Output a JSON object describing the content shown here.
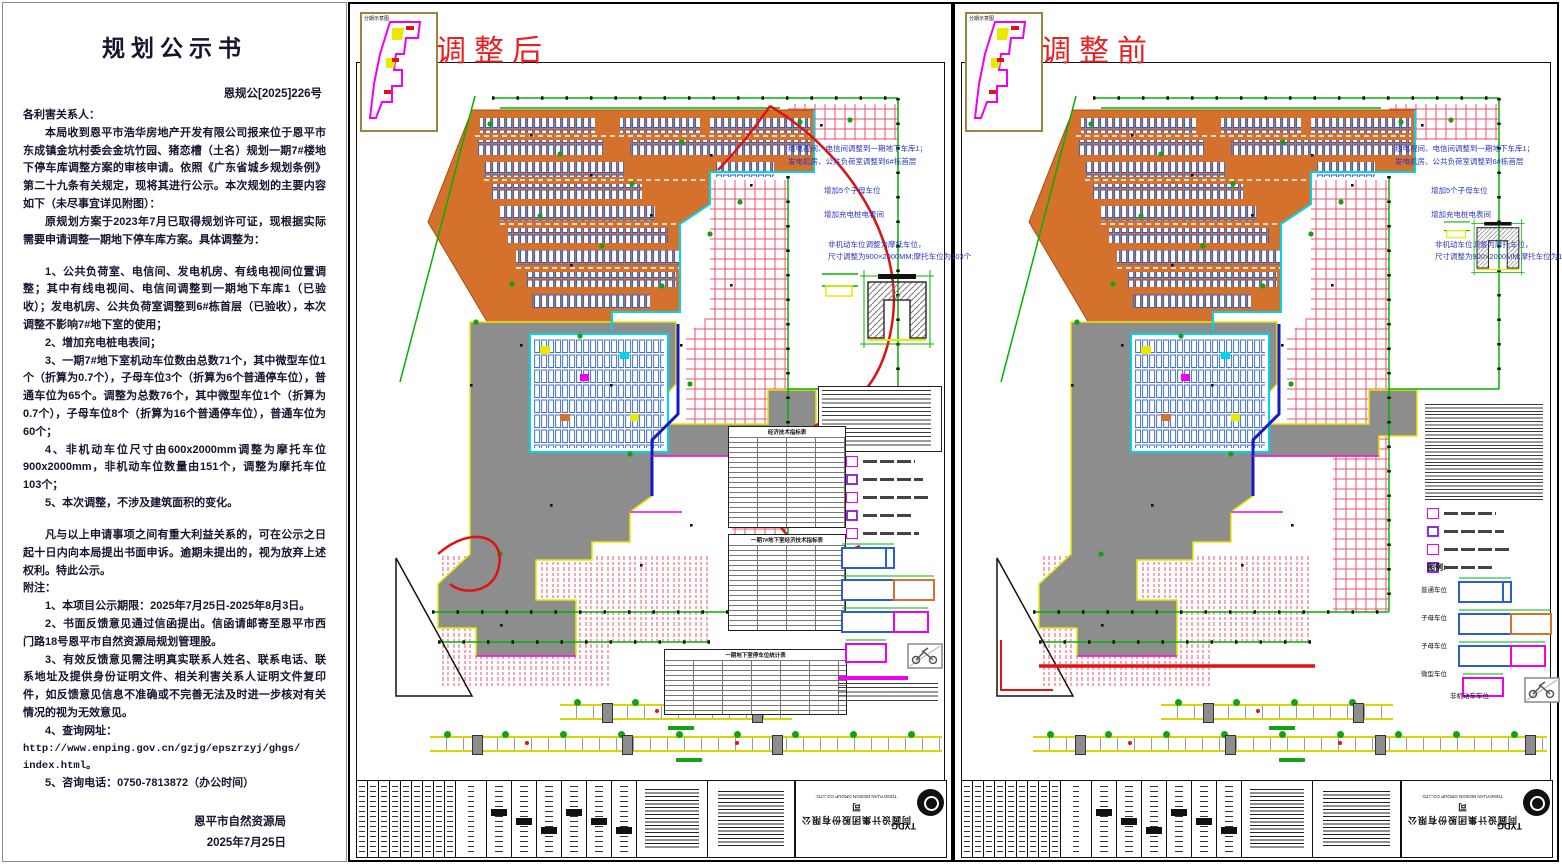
{
  "colors": {
    "accent_red": "#e01212",
    "boundary_green": "#00b400",
    "hatch_red": "#ef5168",
    "building_orange": "#d4712d",
    "stall_blue": "#2b5fd0",
    "magenta": "#f000f0",
    "cyan": "#00d4e8",
    "basement_gray": "#8d8d8d",
    "outline_yellow": "#e8e800",
    "annotation_blue": "#2a35c0",
    "doc_text": "#151530"
  },
  "document": {
    "title": "规划公示书",
    "doc_number": "恩规公[2025]226号",
    "salutation": "各利害关系人：",
    "p1": "本局收到恩平市浩华房地产开发有限公司报来位于恩平市东成镇金坑村委会金坑竹园、猪恋槽（土名）规划一期7#楼地下停车库调整方案的审核申请。依照《广东省城乡规划条例》第二十九条有关规定，现将其进行公示。本次规划的主要内容如下（未尽事宜详见附图）：",
    "p2": "原规划方案于2023年7月已取得规划许可证，现根据实际需要申请调整一期地下停车库方案。具体调整为：",
    "items": [
      "1、公共负荷室、电信间、发电机房、有线电视间位置调整；其中有线电视间、电信间调整到一期地下车库1（已验收）；发电机房、公共负荷室调整到6#栋首层（已验收），本次调整不影响7#地下室的使用；",
      "2、增加充电桩电表间；",
      "3、一期7#地下室机动车位数由总数71个，其中微型车位1个（折算为0.7个），子母车位3个（折算为6个普通停车位），普通车位为65个。调整为总数76个，其中微型车位1个（折算为0.7个），子母车位8个（折算为16个普通停车位），普通车位为60个；",
      "4、非机动车位尺寸由600x2000mm调整为摩托车位900x2000mm，非机动车位数量由151个，调整为摩托车位103个；",
      "5、本次调整，不涉及建筑面积的变化。"
    ],
    "appeal": "凡与以上申请事项之间有重大利益关系的，可在公示之日起十日内向本局提出书面申诉。逾期未提出的，视为放弃上述权利。特此公示。",
    "notes_label": "附注：",
    "notes": [
      "1、本项目公示期限：2025年7月25日-2025年8月3日。",
      "2、书面反馈意见通过信函提出。信函请邮寄至恩平市西门路18号恩平市自然资源局规划管理股。",
      "3、有效反馈意见需注明真实联系人姓名、联系电话、联系地址及提供身份证明文件、相关利害关系人证明文件复印件，如反馈意见信息不准确或不完善无法及时进一步核对有关情况的视为无效意见。"
    ],
    "note4": "4、查询网址：",
    "url1": "http://www.enping.gov.cn/gzjg/epszrzyj/ghgs/",
    "url2": "index.html。",
    "note5": "5、咨询电话：0750-7813872（办公时间）",
    "signature": "恩平市自然资源局",
    "date": "2025年7月25日"
  },
  "panel_after": {
    "title": "调整后",
    "inset_label": "分期示意图",
    "ann": {
      "l1": "线电视间、电信间调整到一期地下车库1；",
      "l2": "发电机房、公共负荷室调整到6#栋首层",
      "l3": "增加5个子母车位",
      "l4": "增加充电桩电表间",
      "l5": "非机动车位调整为摩托车位，",
      "l6": "尺寸调整为900×2000MM;摩托车位为103个"
    },
    "tables": {
      "t1_title": "经济技术指标表",
      "t2_title": "一期7#地下室经济技术指标表",
      "t3_title": "一期地下室停车位统计表"
    }
  },
  "panel_before": {
    "title": "调整前",
    "inset_label": "分期示意图",
    "legend_title": "图例:",
    "ann": {
      "l1": "线电视间、电信间调整到一期地下车库1；",
      "l2": "发电机房、公共负荷室调整到6#栋首层",
      "l3": "增加5个子母车位",
      "l4": "增加充电桩电表间",
      "l5": "非机动车位调整为摩托车位，",
      "l6": "尺寸调整为900×2000MM;摩托车位为113个"
    }
  },
  "legend": {
    "stall_labels": [
      "普通车位",
      "子母车位",
      "子母车位",
      "微型车位"
    ],
    "moto_label": "非机动车车位"
  },
  "titleblock": {
    "logo": "TYDG",
    "company_cn": "同圆设计集团股份有限公司",
    "company_en": "TONGYUAN DESIGN GROUP CO.,LTD."
  }
}
